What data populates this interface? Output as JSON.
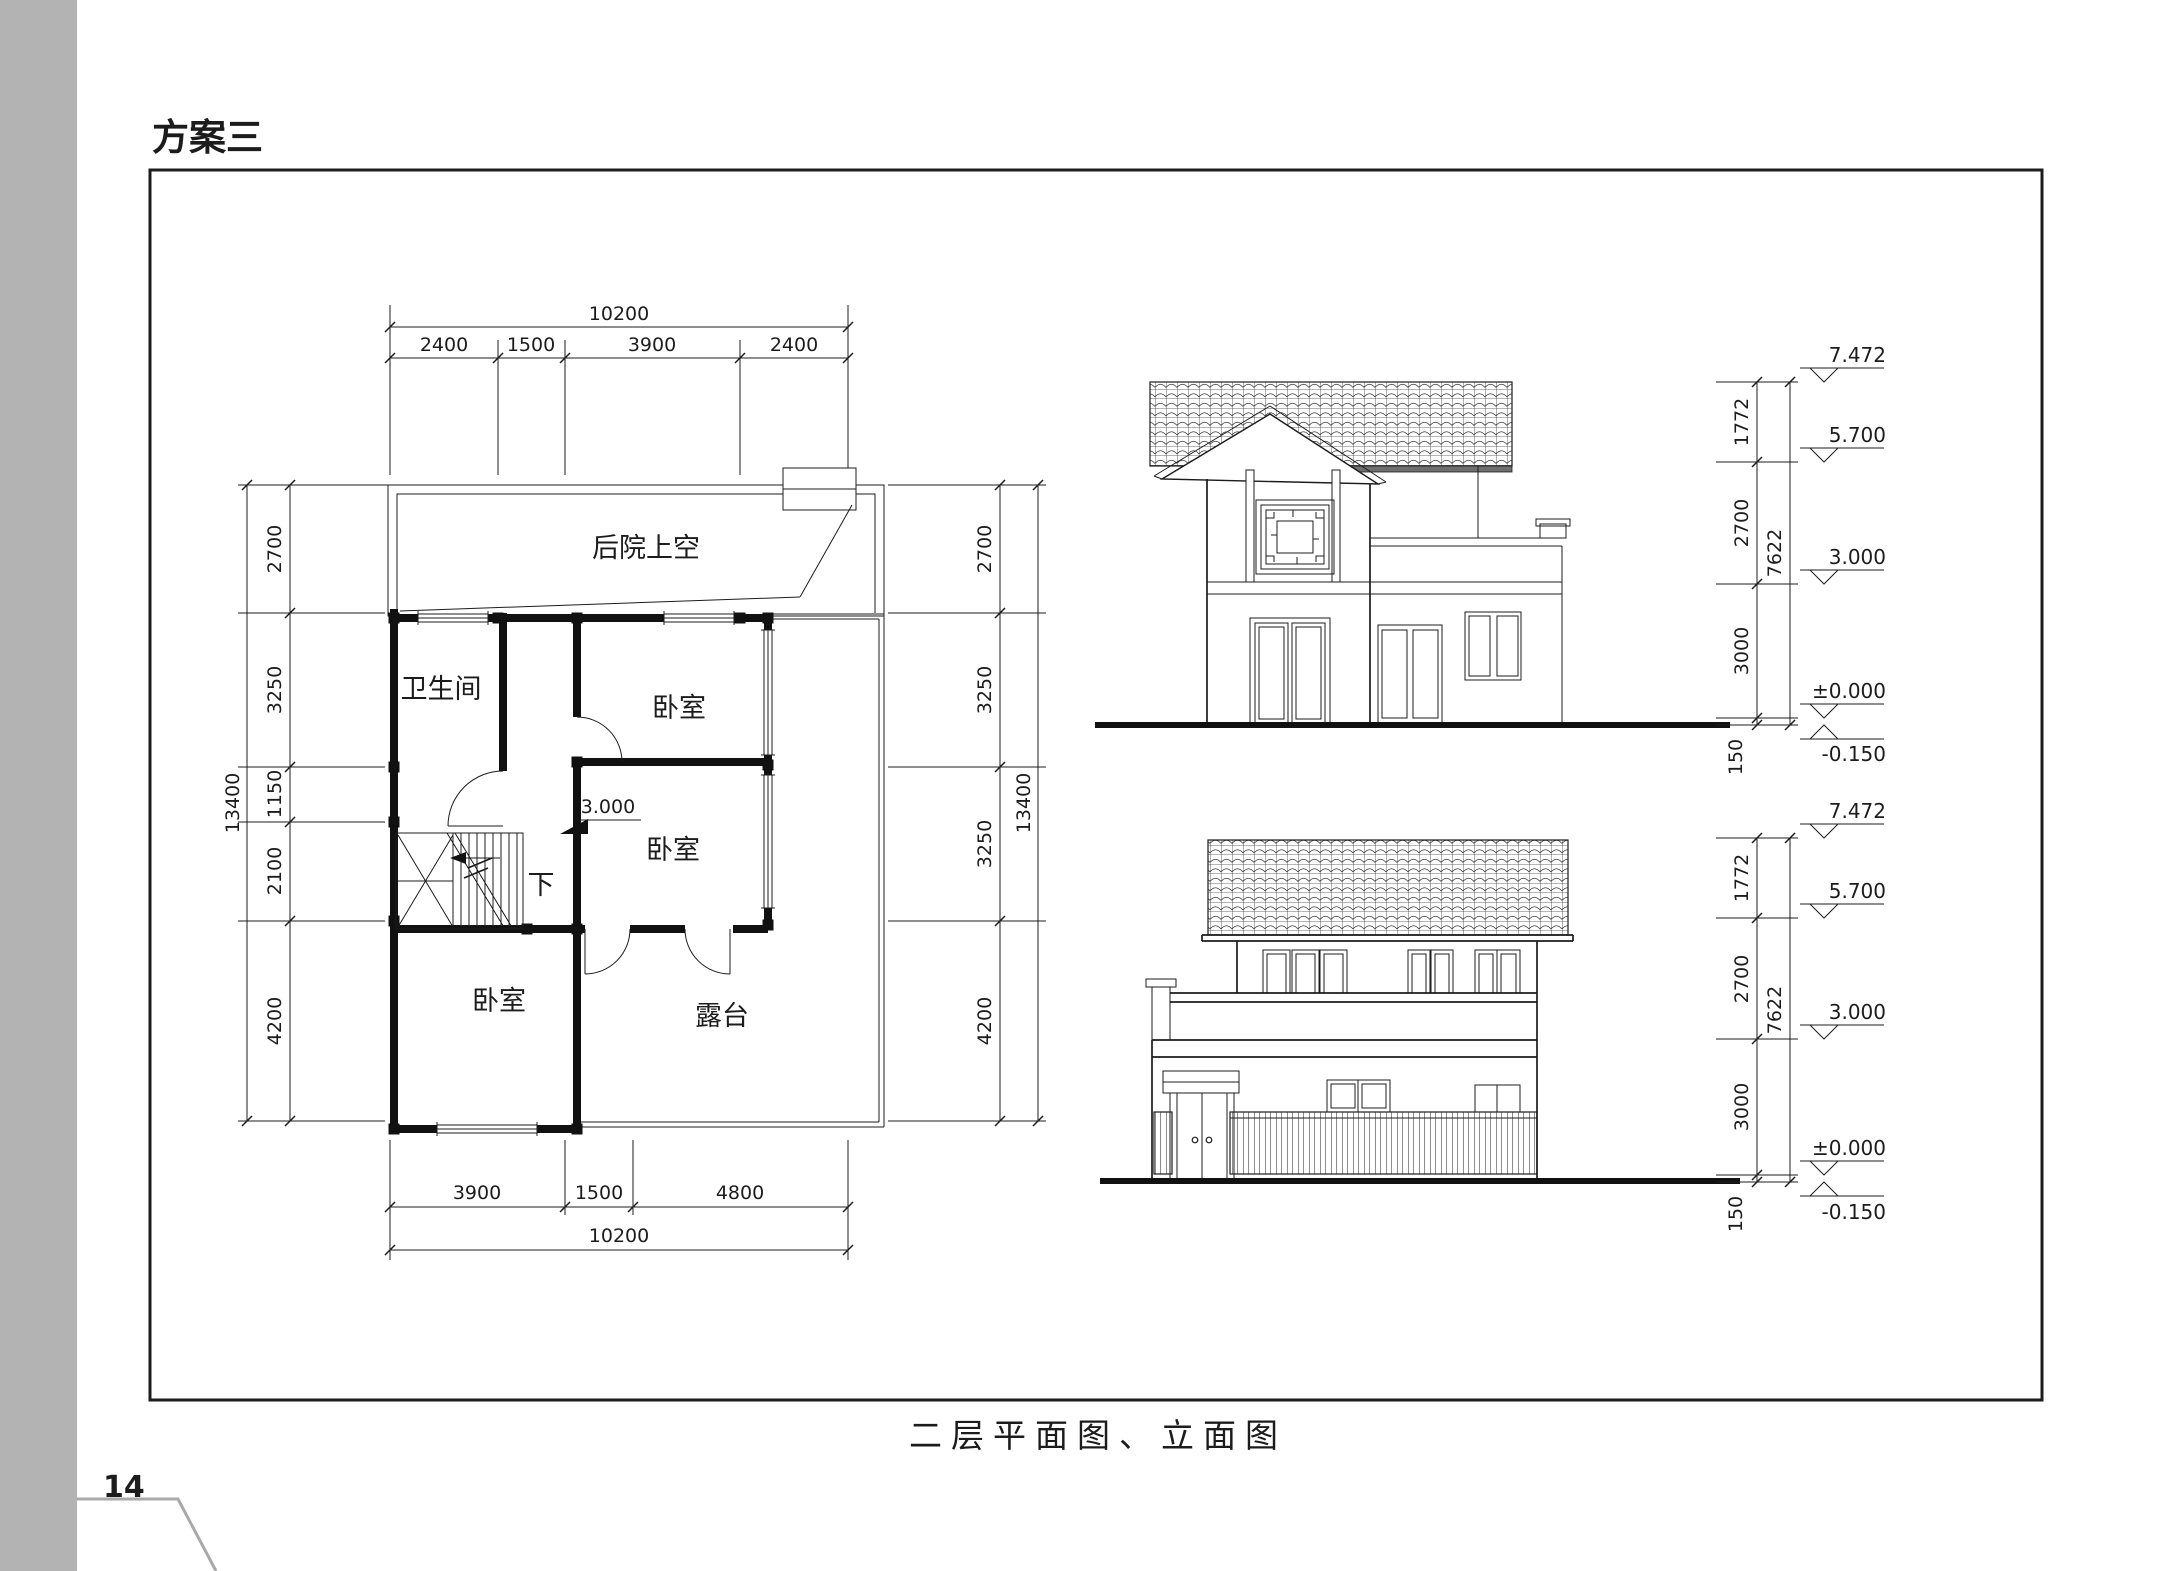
{
  "page": {
    "title": "方案三",
    "caption": "二层平面图、立面图",
    "page_number": "14"
  },
  "colors": {
    "ink": "#1c1c1c",
    "sidebar_gray": "#b3b3b3",
    "corner_line_gray": "#a9a9a9"
  },
  "floor_plan": {
    "labels": {
      "backyard": "后院上空",
      "bathroom": "卫生间",
      "bedroom_top": "卧室",
      "bedroom_mid": "卧室",
      "bedroom_bottom": "卧室",
      "terrace": "露台",
      "stair_down": "下",
      "landing_level": "3.000"
    },
    "dim_top": {
      "overall": "10200",
      "segments": [
        "2400",
        "1500",
        "3900",
        "2400"
      ]
    },
    "dim_bottom": {
      "overall": "10200",
      "segments": [
        "3900",
        "1500",
        "4800"
      ]
    },
    "dim_left": {
      "overall": "13400",
      "segments": [
        "2700",
        "3250",
        "1150",
        "2100",
        "4200"
      ]
    },
    "dim_right": {
      "overall": "13400",
      "segments": [
        "2700",
        "3250",
        "3250",
        "4200"
      ]
    }
  },
  "elevation_side": {
    "heights": [
      "1772",
      "2700",
      "3000",
      "150"
    ],
    "overall": "7622",
    "levels": [
      "7.472",
      "5.700",
      "3.000",
      "±0.000",
      "-0.150"
    ]
  },
  "elevation_front": {
    "heights": [
      "1772",
      "2700",
      "3000",
      "150"
    ],
    "overall": "7622",
    "levels": [
      "7.472",
      "5.700",
      "3.000",
      "±0.000",
      "-0.150"
    ]
  }
}
